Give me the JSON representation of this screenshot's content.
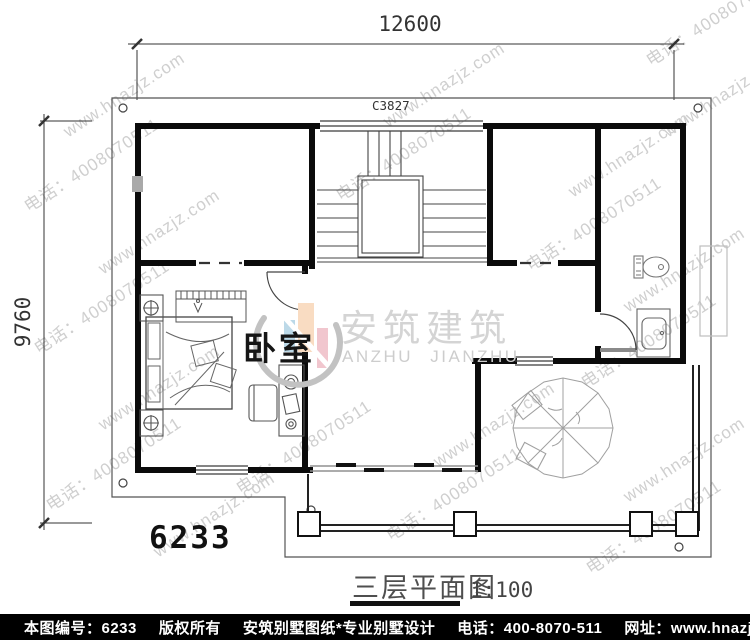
{
  "page": {
    "kind": "architectural floor plan drawing",
    "colors": {
      "wall": "#0b0b0b",
      "thin_line": "#3a3a3a",
      "watermark": "#cfcfcf",
      "footer_bg": "#000000",
      "footer_fg": "#ffffff",
      "logo_blue": "#bcd9e8",
      "logo_peach": "#f9dcc2",
      "logo_pink": "#f1c6ce",
      "logo_gray": "#c2c2c2"
    }
  },
  "dimensions": {
    "top": "12600",
    "left": "9760"
  },
  "labels": {
    "window_code": "C3827",
    "bedroom": "卧室",
    "plan_number": "6233"
  },
  "title": {
    "text": "三层平面图",
    "scale": "1:100"
  },
  "logo": {
    "cn": "安筑建筑",
    "en": "ANZHU JIANZHU"
  },
  "footer": {
    "items": [
      "本图编号：6233",
      "版权所有",
      "安筑别墅图纸*专业别墅设计",
      "电话：400-8070-511",
      "网址：www.hnazjz.com"
    ]
  },
  "watermarks": [
    {
      "x": 60,
      "y": 125,
      "text": "www.hnazjz.com"
    },
    {
      "x": 18,
      "y": 196,
      "text": "电话：4008070511"
    },
    {
      "x": 95,
      "y": 262,
      "text": "www.hnazjz.com"
    },
    {
      "x": 28,
      "y": 338,
      "text": "电话：4008070511"
    },
    {
      "x": 95,
      "y": 418,
      "text": "www.hnazjz.com"
    },
    {
      "x": 40,
      "y": 495,
      "text": "电话：4008070511"
    },
    {
      "x": 380,
      "y": 115,
      "text": "www.hnazjz.com"
    },
    {
      "x": 330,
      "y": 185,
      "text": "电话：4008070511"
    },
    {
      "x": 640,
      "y": 50,
      "text": "电话：4008070511"
    },
    {
      "x": 660,
      "y": 125,
      "text": "www.hnazjz.com"
    },
    {
      "x": 565,
      "y": 185,
      "text": "www.hnazjz.com"
    },
    {
      "x": 520,
      "y": 255,
      "text": "电话：4008070511"
    },
    {
      "x": 620,
      "y": 300,
      "text": "www.hnazjz.com"
    },
    {
      "x": 575,
      "y": 372,
      "text": "电话：4008070511"
    },
    {
      "x": 430,
      "y": 455,
      "text": "www.hnazjz.com"
    },
    {
      "x": 380,
      "y": 525,
      "text": "电话：4008070511"
    },
    {
      "x": 620,
      "y": 490,
      "text": "www.hnazjz.com"
    },
    {
      "x": 580,
      "y": 558,
      "text": "电话：4008070511"
    },
    {
      "x": 150,
      "y": 545,
      "text": "www.hnazjz.com"
    },
    {
      "x": 230,
      "y": 478,
      "text": "电话：4008070511"
    }
  ]
}
